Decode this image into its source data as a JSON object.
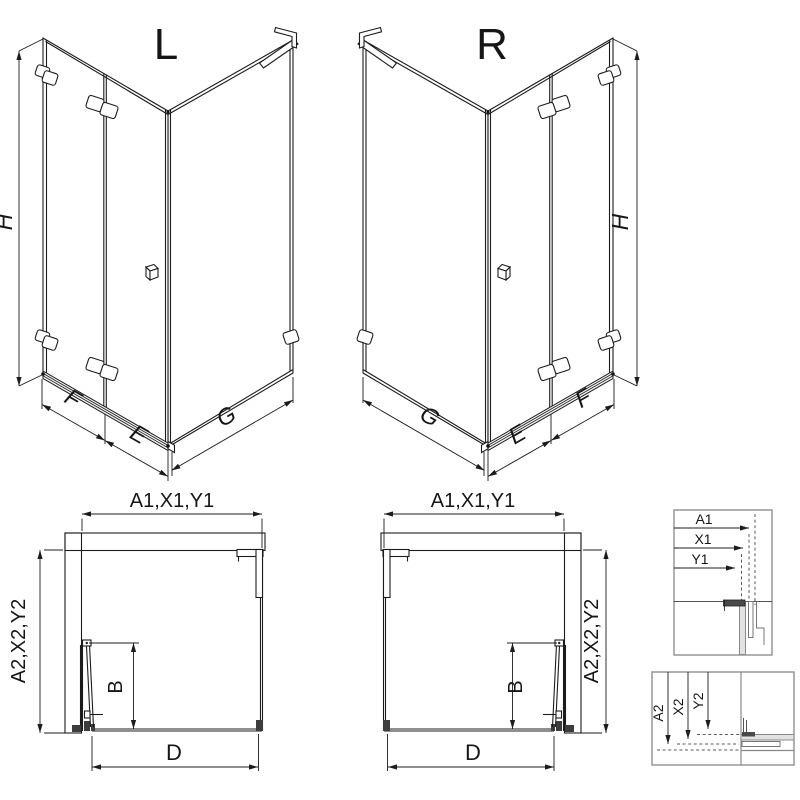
{
  "labels": {
    "left_variant": "L",
    "right_variant": "R"
  },
  "iso_dims": {
    "height": "H",
    "front_fixed": "F",
    "front_door": "E",
    "side_panel": "G"
  },
  "plan_dims": {
    "top": "A1,X1,Y1",
    "side": "A2,X2,Y2",
    "door": "B",
    "opening": "D"
  },
  "detail_top": {
    "labels": [
      "A1",
      "X1",
      "Y1"
    ]
  },
  "detail_bottom": {
    "labels": [
      "A2",
      "X2",
      "Y2"
    ]
  },
  "colors": {
    "line": "#1c1c1c",
    "detail_frame": "#909090",
    "glass_gray": "#e2e2e2",
    "dark_fill": "#3d3d3d",
    "background": "#ffffff"
  }
}
